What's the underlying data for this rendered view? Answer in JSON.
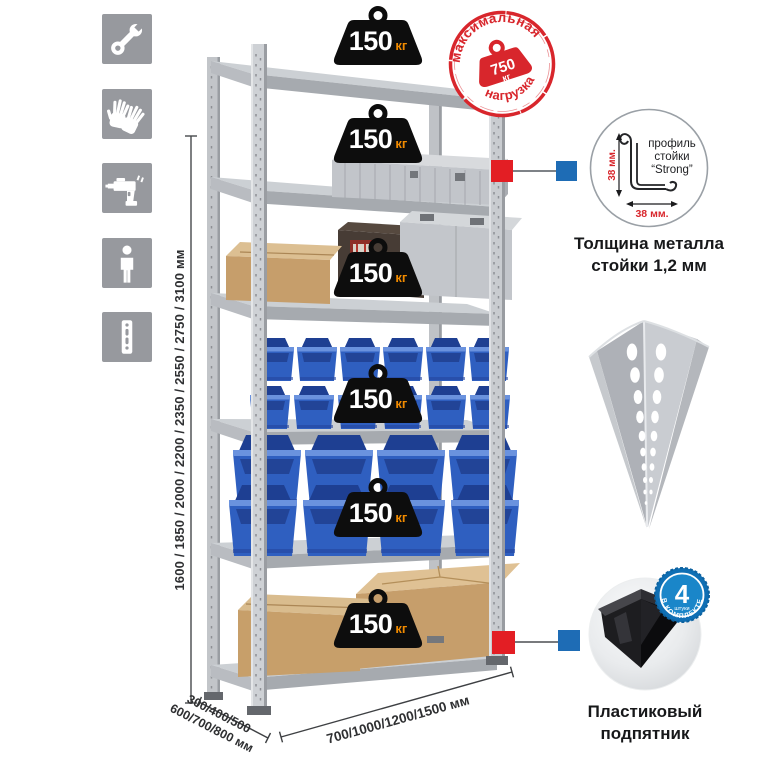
{
  "sidebar": {
    "icons": [
      {
        "icon": "wrench"
      },
      {
        "icon": "work-gloves"
      },
      {
        "icon": "drill"
      },
      {
        "icon": "person"
      },
      {
        "icon": "perforated-upright"
      }
    ]
  },
  "rack": {
    "shelf_count": 6,
    "weights": [
      {
        "value": "150",
        "unit": "кг"
      },
      {
        "value": "150",
        "unit": "кг"
      },
      {
        "value": "150",
        "unit": "кг"
      },
      {
        "value": "150",
        "unit": "кг"
      },
      {
        "value": "150",
        "unit": "кг"
      },
      {
        "value": "150",
        "unit": "кг"
      }
    ]
  },
  "stamp": {
    "arc_top": "максимальная",
    "arc_bottom": "нагрузка",
    "value": "750",
    "unit": "кг"
  },
  "dimensions": {
    "height": "1600 / 1850 / 2000 / 2200 / 2350 / 2550 / 2750 / 3100 мм",
    "width": "700/1000/1200/1500 мм",
    "depth_line1": "300/400/500",
    "depth_line2": "600/700/800 мм"
  },
  "profile_detail": {
    "label_line1": "профиль",
    "label_line2": "стойки",
    "label_line3": "“Strong”",
    "dim_v": "38 мм.",
    "dim_h": "38 мм.",
    "caption_line1": "Толщина металла",
    "caption_line2": "стойки 1,2 мм"
  },
  "foot_detail": {
    "badge_value": "4",
    "badge_sub": "штуки",
    "badge_arc": "в комплекте",
    "caption_line1": "Пластиковый",
    "caption_line2": "подпятник"
  },
  "colors": {
    "icon_tile": "#97999e",
    "stamp_red": "#d8262c",
    "connector_red": "#e31e24",
    "connector_blue": "#1e6cb5",
    "badge_blue": "#1a86c9",
    "bin_blue": "#2f5fc0",
    "weight_black": "#0d0d0d",
    "weight_unit_orange": "#f08a00",
    "cardboard": "#c69e6b",
    "metal_gray": "#c7cacd"
  }
}
